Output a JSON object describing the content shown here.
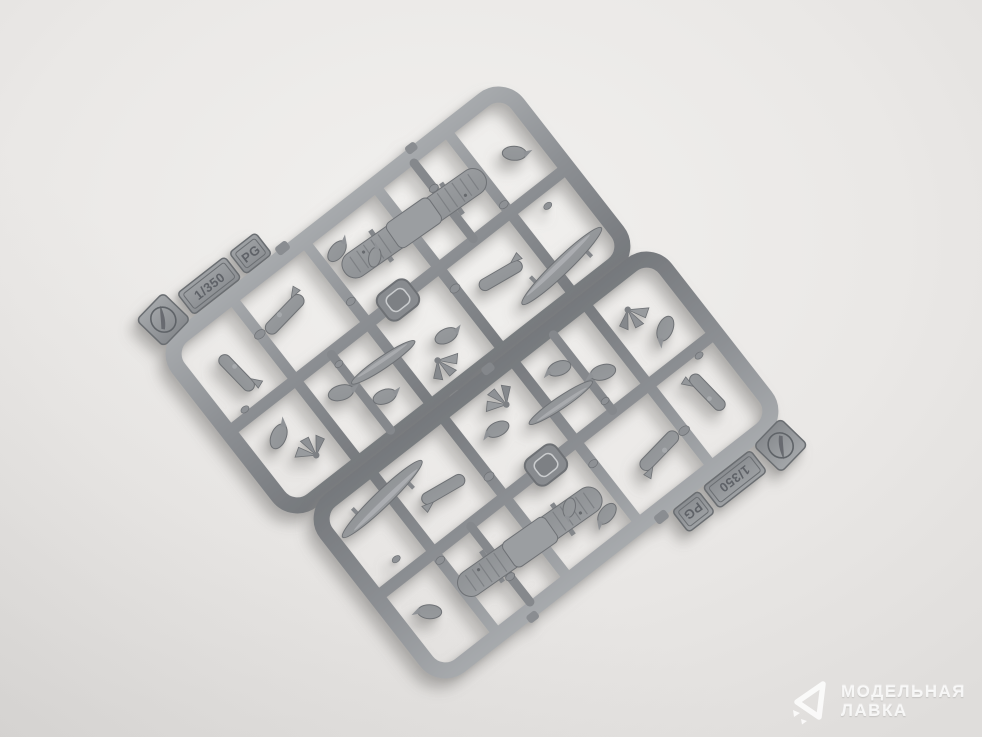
{
  "meta": {
    "description": "Studio product photograph of two identical grey injection-moulded plastic sprues (model-kit runners) containing 1/350 scale ship-borne aircraft parts, laid diagonally on a neutral light background",
    "background_color": "#edecea",
    "background_edge_color": "#e0deDC",
    "plastic_color": "#8d9094",
    "plastic_highlight": "#c2c4c6",
    "plastic_shadow": "#6b6e72"
  },
  "sprue_tag": {
    "scale_label": "1/350",
    "code_label": "PG",
    "logo": "manufacturer-swoosh-emblem"
  },
  "sprues": [
    {
      "id": "sprue-a",
      "position": "upper-left"
    },
    {
      "id": "sprue-b",
      "position": "lower-right"
    }
  ],
  "parts_depicted": [
    "corrugated-monoplane-wing",
    "long-seaplane-float",
    "slim-float",
    "fuselage-half",
    "teardrop-float",
    "propeller-fan",
    "small-detail-bits",
    "injection-gate-knob"
  ],
  "watermark": {
    "line1": "МОДЕЛЬНАЯ",
    "line2": "ЛАВКА",
    "logo": "paper-plane-logo",
    "color": "rgba(255,255,255,0.82)"
  }
}
